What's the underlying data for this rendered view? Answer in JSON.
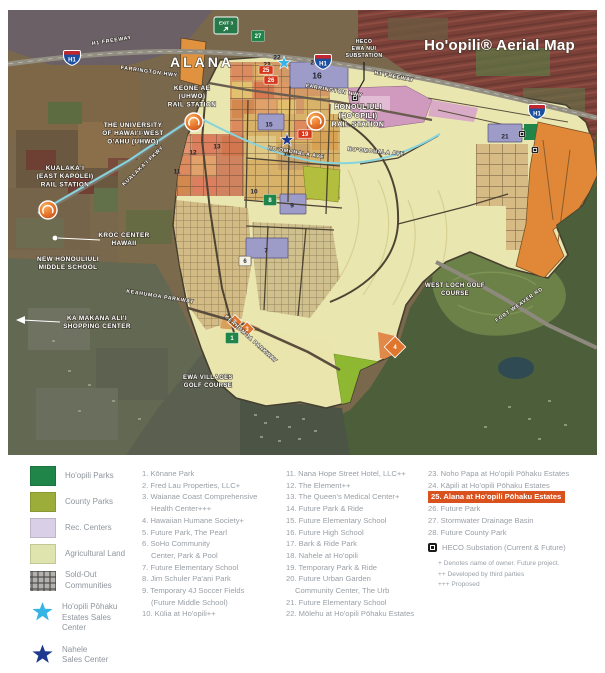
{
  "colors": {
    "star_light": "#35b4e5",
    "star_dark": "#1d3a8f",
    "red_chip": "#d6381c",
    "green_chip": "#1f8549",
    "orange_chip": "#e0762e"
  },
  "map": {
    "title": "Ho'opili® Aerial Map",
    "exit_sign": {
      "label": "EXIT 3",
      "x": 206,
      "y": 7
    },
    "shields": [
      {
        "label": "H1",
        "x": 55,
        "y": 40
      },
      {
        "label": "H1",
        "x": 306,
        "y": 44
      },
      {
        "label": "H1",
        "x": 520,
        "y": 94
      }
    ],
    "road_labels": [
      {
        "text": "H1 FREEWAY",
        "x": 104,
        "y": 32,
        "rot": -9
      },
      {
        "text": "H1 FREEWAY",
        "x": 386,
        "y": 68,
        "rot": 11
      },
      {
        "text": "FARRINGTON HWY",
        "x": 141,
        "y": 63,
        "rot": 8
      },
      {
        "text": "FARRINGTON HWY",
        "x": 326,
        "y": 82,
        "rot": 10
      },
      {
        "text": "KUALAKA'I PKWY",
        "x": 136,
        "y": 157,
        "rot": -44
      },
      {
        "text": "HO'OMOHALA AVE",
        "x": 288,
        "y": 144,
        "rot": 9
      },
      {
        "text": "HO'OMOHALA AVE",
        "x": 368,
        "y": 143,
        "rot": 5
      },
      {
        "text": "KEAHUMOA PARKWAY",
        "x": 152,
        "y": 288,
        "rot": 9
      },
      {
        "text": "KEAHUMOA PARKWAY",
        "x": 242,
        "y": 330,
        "rot": 42
      },
      {
        "text": "FORT WEAVER RD",
        "x": 512,
        "y": 296,
        "rot": -35
      }
    ],
    "place_labels": [
      {
        "lines": [
          "ALANA"
        ],
        "x": 194,
        "y": 57,
        "size": 14,
        "ls": 3
      },
      {
        "lines": [
          "HECO",
          "EWA NUI",
          "SUBSTATION"
        ],
        "x": 356,
        "y": 33,
        "size": 5.2
      },
      {
        "lines": [
          "KEONE AE",
          "(UHWO)",
          "RAIL STATION"
        ],
        "x": 184,
        "y": 80,
        "size": 6.4
      },
      {
        "lines": [
          "THE UNIVERSITY",
          "OF HAWAI'I-WEST",
          "O'AHU (UHWO)"
        ],
        "x": 125,
        "y": 117,
        "size": 6.4
      },
      {
        "lines": [
          "KUALAKA'I",
          "(EAST KAPOLEI)",
          "RAIL STATION"
        ],
        "x": 57,
        "y": 160,
        "size": 6.4
      },
      {
        "lines": [
          "HONOULIULI",
          "(HO'OPILI)",
          "RAIL STATION"
        ],
        "x": 350,
        "y": 99,
        "size": 7
      },
      {
        "lines": [
          "KROC CENTER",
          "HAWAII"
        ],
        "x": 116,
        "y": 227,
        "size": 6.4
      },
      {
        "lines": [
          "NEW HONOULIULI",
          "MIDDLE SCHOOL"
        ],
        "x": 60,
        "y": 251,
        "size": 6.4
      },
      {
        "lines": [
          "KA MAKANA ALI'I",
          "SHOPPING CENTER"
        ],
        "x": 89,
        "y": 310,
        "size": 6.4
      },
      {
        "lines": [
          "EWA VILLAGES",
          "GOLF COURSE"
        ],
        "x": 200,
        "y": 369,
        "size": 6
      },
      {
        "lines": [
          "WEST LOCH GOLF",
          "COURSE"
        ],
        "x": 447,
        "y": 277,
        "size": 6
      }
    ],
    "markers": [
      {
        "label": "27",
        "x": 250,
        "y": 26,
        "kind": "green"
      },
      {
        "label": "22",
        "x": 269,
        "y": 47,
        "kind": "plain"
      },
      {
        "label": "23",
        "x": 259,
        "y": 54,
        "kind": "plain"
      },
      {
        "label": "",
        "x": 276,
        "y": 53,
        "kind": "star-light"
      },
      {
        "label": "24",
        "x": 306,
        "y": 52,
        "kind": "plain"
      },
      {
        "label": "25",
        "x": 258,
        "y": 60,
        "kind": "red"
      },
      {
        "label": "26",
        "x": 263,
        "y": 70,
        "kind": "red"
      },
      {
        "label": "16",
        "x": 309,
        "y": 66,
        "kind": "plain-lg"
      },
      {
        "label": "15",
        "x": 261,
        "y": 114,
        "kind": "plain"
      },
      {
        "label": "19",
        "x": 297,
        "y": 124,
        "kind": "red"
      },
      {
        "label": "13",
        "x": 209,
        "y": 136,
        "kind": "plain"
      },
      {
        "label": "12",
        "x": 185,
        "y": 142,
        "kind": "plain"
      },
      {
        "label": "11",
        "x": 169,
        "y": 161,
        "kind": "plain"
      },
      {
        "label": "",
        "x": 279,
        "y": 130,
        "kind": "star-dark"
      },
      {
        "label": "18",
        "x": 279,
        "y": 143,
        "kind": "plain"
      },
      {
        "label": "10",
        "x": 246,
        "y": 181,
        "kind": "plain"
      },
      {
        "label": "9",
        "x": 284,
        "y": 195,
        "kind": "plain"
      },
      {
        "label": "8",
        "x": 262,
        "y": 190,
        "kind": "green"
      },
      {
        "label": "21",
        "x": 497,
        "y": 126,
        "kind": "plain"
      },
      {
        "label": "7",
        "x": 258,
        "y": 240,
        "kind": "plain"
      },
      {
        "label": "6",
        "x": 237,
        "y": 251,
        "kind": "white"
      },
      {
        "label": "2",
        "x": 227,
        "y": 312,
        "kind": "orange"
      },
      {
        "label": "3",
        "x": 239,
        "y": 319,
        "kind": "orange"
      },
      {
        "label": "1",
        "x": 224,
        "y": 328,
        "kind": "green"
      },
      {
        "label": "4",
        "x": 387,
        "y": 337,
        "kind": "orange-lg"
      },
      {
        "label": "",
        "x": 347,
        "y": 88,
        "kind": "substation"
      },
      {
        "label": "",
        "x": 514,
        "y": 124,
        "kind": "substation"
      },
      {
        "label": "",
        "x": 527,
        "y": 140,
        "kind": "substation"
      },
      {
        "label": "",
        "x": 186,
        "y": 112,
        "kind": "station"
      },
      {
        "label": "",
        "x": 40,
        "y": 200,
        "kind": "station"
      },
      {
        "label": "",
        "x": 308,
        "y": 111,
        "kind": "station"
      }
    ]
  },
  "legend": {
    "highlight_color": "#d9511d",
    "swatches": [
      {
        "kind": "hoopili-parks",
        "color": "#1f8549",
        "label_lines": [
          "Ho'opili Parks"
        ]
      },
      {
        "kind": "county-parks",
        "color": "#9cad39",
        "label_lines": [
          "County Parks"
        ]
      },
      {
        "kind": "rec-centers",
        "color": "#d9cfe6",
        "label_lines": [
          "Rec. Centers"
        ]
      },
      {
        "kind": "agricultural-land",
        "color": "#dfe3ae",
        "label_lines": [
          "Agricultural Land"
        ]
      },
      {
        "kind": "sold-out",
        "color": "#8c8c8c",
        "label_lines": [
          "Sold-Out",
          "Communities"
        ]
      },
      {
        "kind": "star-light",
        "color": "#35b4e5",
        "label_lines": [
          "Ho'opili Pōhaku",
          "Estates Sales",
          "Center"
        ]
      },
      {
        "kind": "star-dark",
        "color": "#1d3a8f",
        "label_lines": [
          "Nahele",
          "Sales Center"
        ]
      }
    ],
    "columns": {
      "col1": [
        {
          "lines": [
            "1. Kōnane Park"
          ]
        },
        {
          "lines": [
            "2. Fred Lau Properties, LLC+"
          ]
        },
        {
          "lines": [
            "3. Waianae Coast Comprehensive",
            "Health Center+++"
          ]
        },
        {
          "lines": [
            "4. Hawaiian Humane Society+"
          ]
        },
        {
          "lines": [
            "5. Future Park, The Pearl"
          ]
        },
        {
          "lines": [
            "6. SoHo Community",
            "Center, Park & Pool"
          ]
        },
        {
          "lines": [
            "7. Future Elementary School"
          ]
        },
        {
          "lines": [
            "8. Jim Schuler Pa'ani Park"
          ]
        },
        {
          "lines": [
            "9. Temporary 4J Soccer Fields",
            "(Future Middle School)"
          ]
        },
        {
          "lines": [
            "10. Kūlia at Ho'opili++"
          ]
        }
      ],
      "col2": [
        {
          "lines": [
            "11. Nana Hope Street Hotel, LLC++"
          ]
        },
        {
          "lines": [
            "12. The Element++"
          ]
        },
        {
          "lines": [
            "13. The Queen's Medical Center+"
          ]
        },
        {
          "lines": [
            "14. Future Park & Ride"
          ]
        },
        {
          "lines": [
            "15. Future Elementary School"
          ]
        },
        {
          "lines": [
            "16. Future High School"
          ]
        },
        {
          "lines": [
            "17. Bark & Ride Park"
          ]
        },
        {
          "lines": [
            "18. Nahele at Ho'opili"
          ]
        },
        {
          "lines": [
            "19. Temporary Park & Ride"
          ]
        },
        {
          "lines": [
            "20. Future Urban Garden",
            "Community Center, The Urb"
          ]
        },
        {
          "lines": [
            "21. Future Elementary School"
          ]
        },
        {
          "lines": [
            "22. Mōlehu at Ho'opili Pōhaku Estates"
          ]
        }
      ],
      "col3": [
        {
          "lines": [
            "23. Noho Papa at Ho'opili Pōhaku Estates"
          ]
        },
        {
          "lines": [
            "24. Kāpili at Ho'opili Pōhaku Estates"
          ]
        },
        {
          "lines": [
            "25. Alana at Ho'opili Pōhaku Estates"
          ],
          "highlight": true
        },
        {
          "lines": [
            "26. Future Park"
          ]
        },
        {
          "lines": [
            "27. Stormwater Drainage Basin"
          ]
        },
        {
          "lines": [
            "28. Future County Park"
          ]
        },
        {
          "kind": "heco",
          "lines": [
            "HECO Substation (Current & Future)"
          ]
        }
      ]
    },
    "notes": [
      "+ Denotes name of owner. Future project.",
      "++ Developed by third parties",
      "+++ Proposed"
    ]
  }
}
